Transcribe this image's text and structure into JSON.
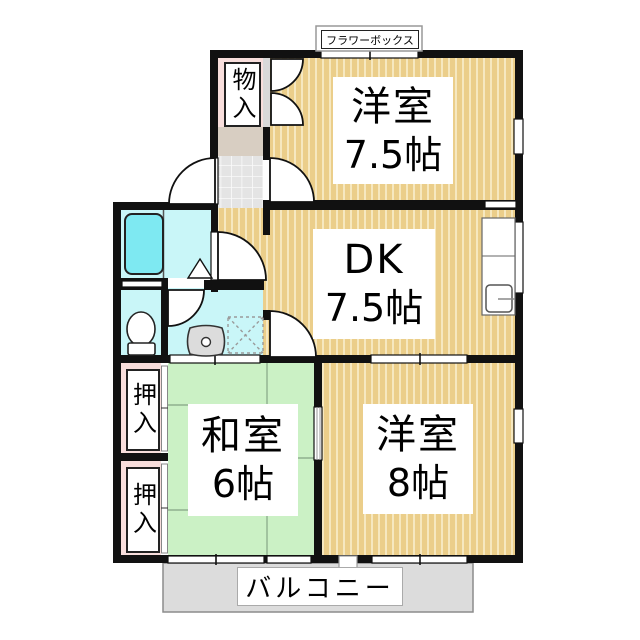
{
  "plan": {
    "flower_box_label": "フラワーボックス",
    "balcony_label": "バルコニー",
    "rooms": {
      "western_room_1": {
        "name": "洋室",
        "size": "7.5帖"
      },
      "dining_kitchen": {
        "name": "DK",
        "size": "7.5帖"
      },
      "japanese_room": {
        "name": "和室",
        "size": "6帖"
      },
      "western_room_2": {
        "name": "洋室",
        "size": "8帖"
      }
    },
    "storages": {
      "monoire": "物入",
      "oshiire_upper": "押入",
      "oshiire_lower": "押入"
    },
    "fixtures": {
      "bathtub": "bathtub-icon",
      "toilet": "toilet-icon",
      "washbasin": "washbasin-icon",
      "washing_machine_pan": "washing-machine-pan-icon",
      "kitchen_sink": "kitchen-sink-icon",
      "entrance_door": "entrance-door-swing-icon",
      "bathroom_door": "door-swing-icon",
      "folding_door": "folding-door-icon",
      "closet_double_door": "closet-double-door-icon"
    },
    "colors": {
      "wall": "#111111",
      "wood_floor": "#EBCE8A",
      "wood_stripe": "#F6E8C0",
      "tatami": "#CBF1C5",
      "tatami_line": "#8FB08F",
      "water_room": "#C9F6F8",
      "bathtub": "#7EE9F2",
      "closet_pink": "#F8DEDC",
      "genkan_step": "#D8CEC2",
      "genkan_tile": "#E4E4E4",
      "balcony": "#DCDCDC"
    }
  }
}
